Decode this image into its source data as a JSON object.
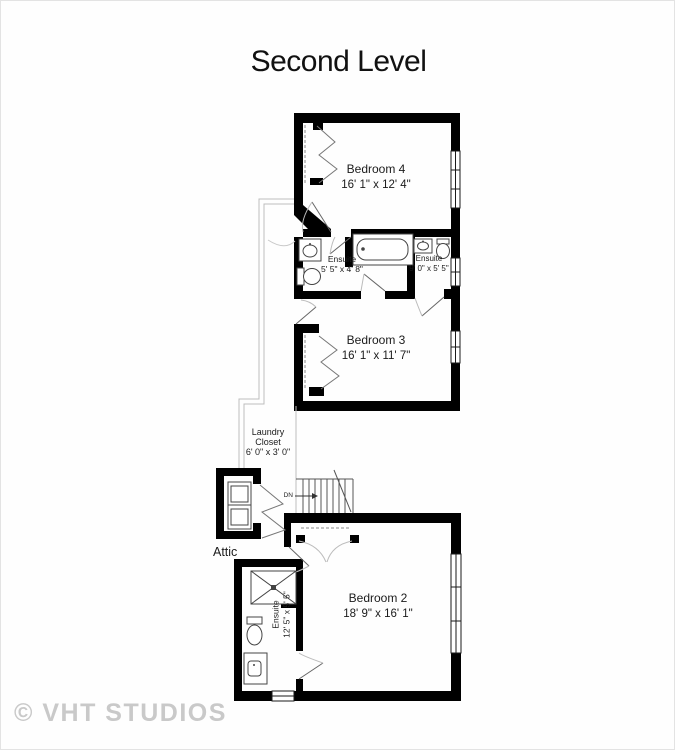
{
  "title": "Second Level",
  "watermark": "© VHT STUDIOS",
  "rooms": {
    "bedroom4": {
      "name": "Bedroom 4",
      "dims": "16' 1\" x 12' 4\""
    },
    "ensuite_top_left": {
      "name": "Ensuite",
      "dims": "5' 5\" x 4' 8\""
    },
    "ensuite_top_right": {
      "name": "Ensuite",
      "dims": "9' 0\" x 5' 5\""
    },
    "bedroom3": {
      "name": "Bedroom 3",
      "dims": "16' 1\" x 11' 7\""
    },
    "laundry_closet": {
      "name_line1": "Laundry",
      "name_line2": "Closet",
      "dims": "6' 0\" x 3' 0\""
    },
    "attic": {
      "name": "Attic"
    },
    "bedroom2": {
      "name": "Bedroom 2",
      "dims": "18' 9\" x 16' 1\""
    },
    "ensuite_bedroom2": {
      "name": "Ensuite",
      "dims": "12' 5\" x 5' 5\""
    }
  },
  "stairs": {
    "direction_label": "DN"
  },
  "colors": {
    "wall": "#000000",
    "fixture_line": "#444444",
    "door_arc": "#bcbcbc",
    "railing": "#bdbdbd",
    "watermark": "#c9c9c9",
    "background": "#fefefe",
    "text": "#1b1b1b"
  }
}
